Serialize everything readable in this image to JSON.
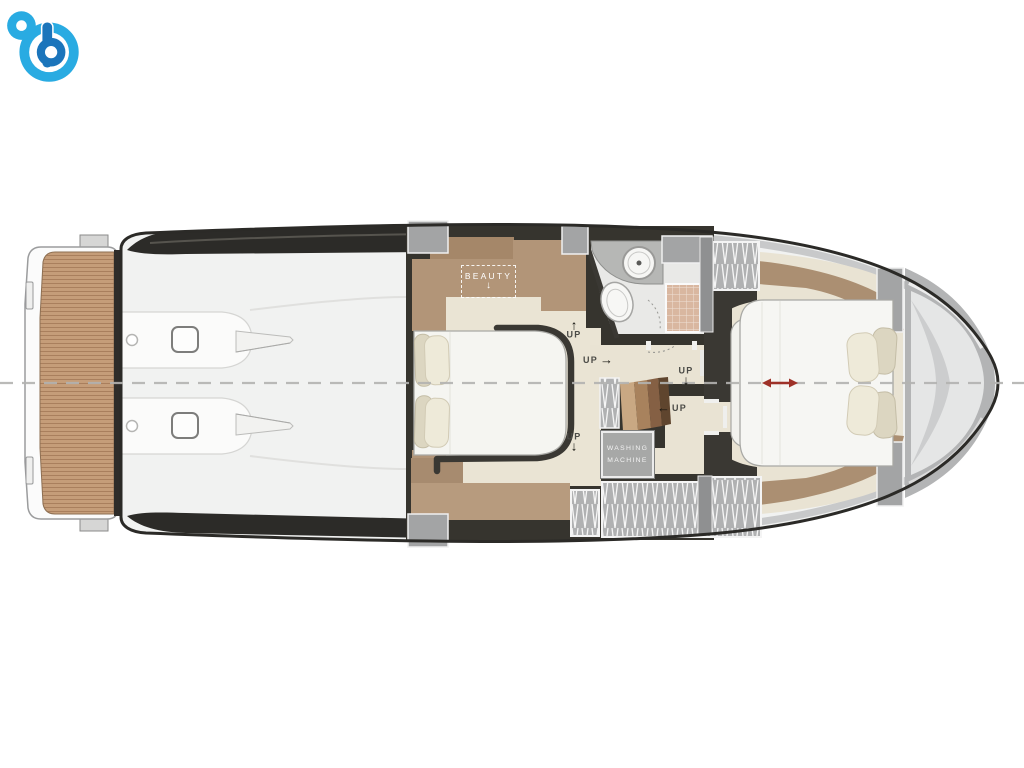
{
  "figure": {
    "type": "yacht-floorplan",
    "view": "lower-deck-top-view"
  },
  "labels": {
    "beauty": "BEAUTY",
    "washing_machine_line1": "WASHING",
    "washing_machine_line2": "MACHINE",
    "up": "UP"
  },
  "arrows": {
    "up": "↑",
    "down": "↓",
    "left": "←",
    "right": "→"
  },
  "colors": {
    "hull_outline": "#2b2a27",
    "deck_white": "#f1f2f1",
    "teak_wood": "#c59d79",
    "cabin_wood": "#b29578",
    "floor_cream": "#eae4d4",
    "wall_dark": "#36342e",
    "bulkhead_gray": "#a3a4a5",
    "shower_tile": "#d9b7a0",
    "centerline_gray": "#b3b3b1",
    "red_dimension_arrow": "#9e3128",
    "logo_light_blue": "#29abe2",
    "logo_dark_blue": "#1b75bb"
  }
}
